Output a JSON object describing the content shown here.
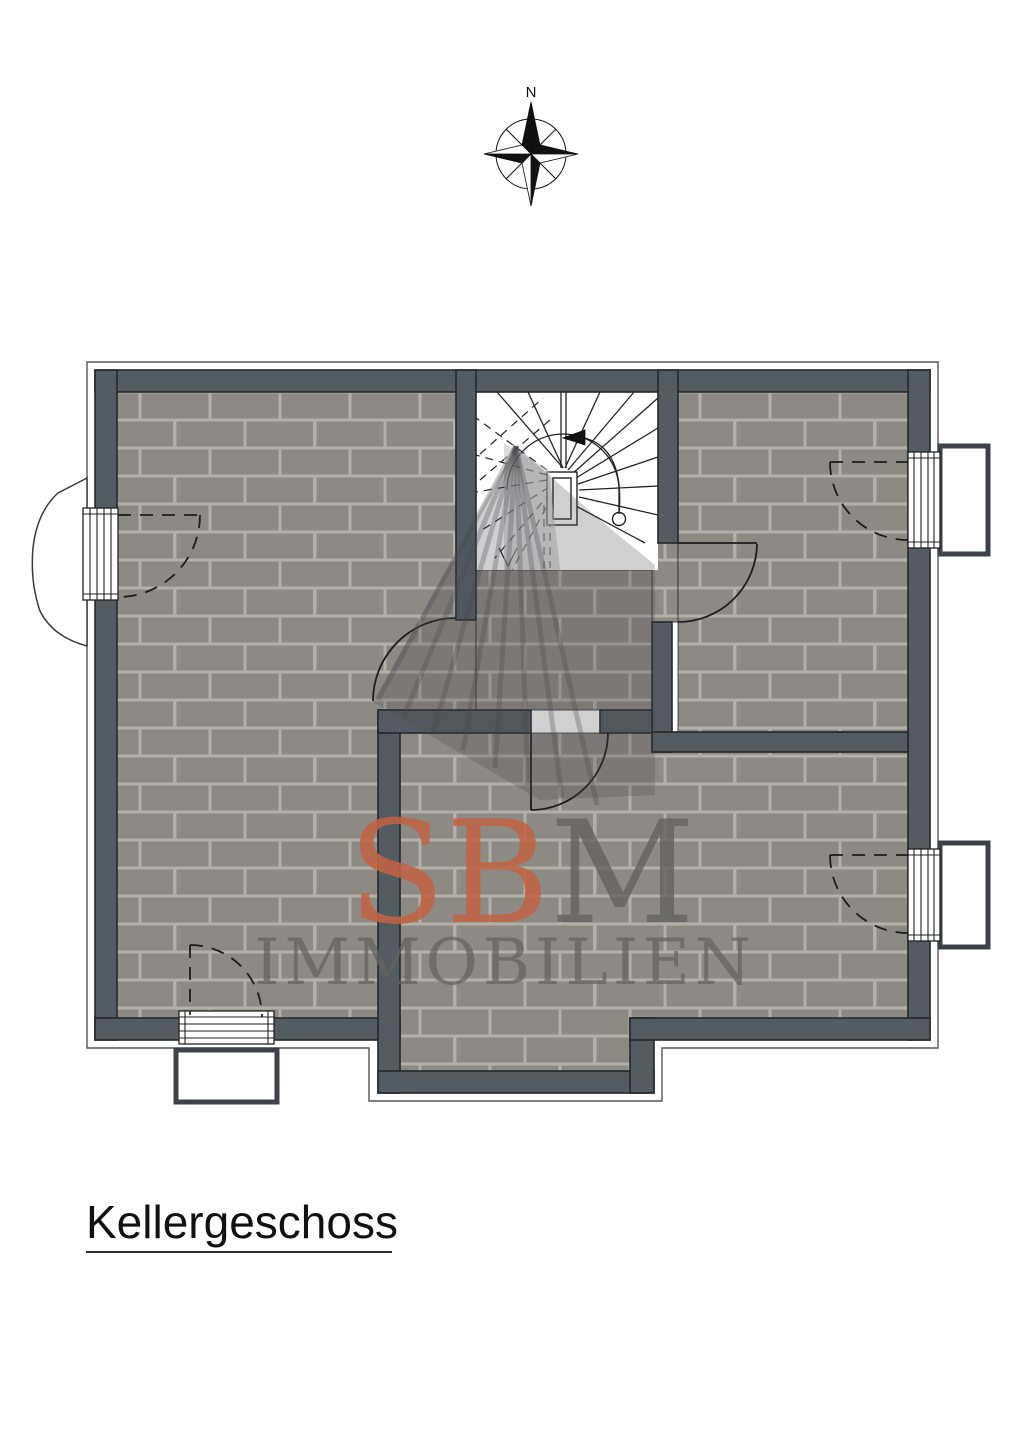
{
  "title": {
    "text": "Kellergeschoss"
  },
  "compass": {
    "north_label": "N"
  },
  "watermark": {
    "brand_accent_part": "SB",
    "brand_gray_part": "M",
    "subtitle": "IMMOBILIEN"
  },
  "colors": {
    "wall": "#535c63",
    "wall_line": "#24282c",
    "brick": "#8d8983",
    "mortar": "#b3b0aa",
    "wm_accent": "#c06344",
    "wm_gray": "#64635f",
    "line": "#1d1d1d",
    "shadow": "#4a4a4e",
    "site_line": "#555555",
    "title_color": "#111111"
  }
}
